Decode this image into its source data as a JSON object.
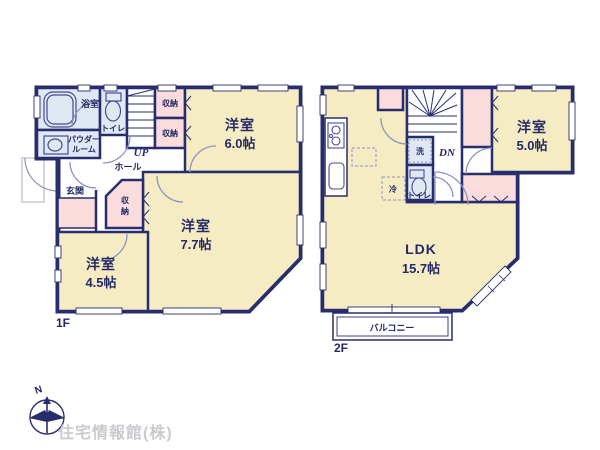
{
  "colors": {
    "wall_navy": "#282d6e",
    "room_cream": "#f6ecc3",
    "closet_pink": "#f9dcdb",
    "wet_blue": "#dfe8f3",
    "door_arc": "#8f94bc",
    "porch_gray": "#b8bcc8",
    "logo_gray": "#c9cbce"
  },
  "floor1": {
    "label": "1F",
    "bath": "浴室",
    "toilet": "トイレ",
    "powder_line1": "パウダー",
    "powder_line2": "ルーム",
    "hall": "ホール",
    "up": "UP",
    "genkan": "玄関",
    "closet_a": "収納",
    "closet_b": "収納",
    "closet_c1": "収",
    "closet_c2": "納",
    "room6": {
      "name": "洋室",
      "size": "6.0帖"
    },
    "room77": {
      "name": "洋室",
      "size": "7.7帖"
    },
    "room45": {
      "name": "洋室",
      "size": "4.5帖"
    }
  },
  "floor2": {
    "label": "2F",
    "dn": "DN",
    "wash": "洗",
    "toilet": "トイレ",
    "fridge": "冷",
    "room5": {
      "name": "洋室",
      "size": "5.0帖"
    },
    "ldk": {
      "name": "LDK",
      "size": "15.7帖"
    },
    "balcony": "バルコニー"
  },
  "compass": {
    "north": "N"
  },
  "branding": {
    "company": "住宅情報館(株)"
  }
}
